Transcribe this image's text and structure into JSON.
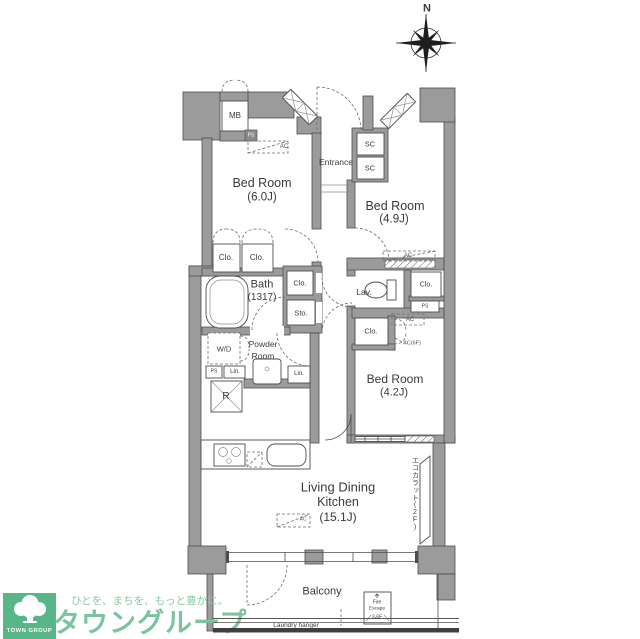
{
  "compass": {
    "north": "N"
  },
  "plan": {
    "rooms": {
      "bedroom1": {
        "name": "Bed Room",
        "size": "(6.0J)"
      },
      "bedroom2": {
        "name": "Bed Room",
        "size": "(4.9J)"
      },
      "bedroom3": {
        "name": "Bed Room",
        "size": "(4.2J)"
      },
      "ldk": {
        "name_line1": "Living Dining",
        "name_line2": "Kitchen",
        "size": "(15.1J)"
      },
      "bath": {
        "name": "Bath",
        "size": "(1317)"
      },
      "powder": {
        "line1": "Powder",
        "line2": "Room"
      },
      "entrance": {
        "name": "Entrance"
      },
      "lavatory": {
        "name": "Lav."
      },
      "balcony": {
        "name": "Balcony"
      }
    },
    "fixtures": {
      "meter_box": "MB",
      "shoe_cabinet_1": "SC",
      "shoe_cabinet_2": "SC",
      "closet_1": "Clo.",
      "closet_2": "Clo.",
      "closet_3": "Clo.",
      "closet_4": "Clo.",
      "closet_5": "Clo.",
      "storage": "Sto.",
      "washer_dryer": "W/D",
      "refrigerator": "R",
      "pipe_space_1": "PS",
      "pipe_space_2": "PS",
      "pipe_space_3": "PS",
      "linen_1": "Lin.",
      "linen_2": "Lin.",
      "ac_1": "AC",
      "ac_2": "AC",
      "ac_3": "AC",
      "ac_ldk": "AC",
      "ac_6f": "AC(6F)",
      "ecocarat": "エコカラット(2F)",
      "laundry_hanger": "Laundry hanger",
      "fire_escape_line1": "Fire",
      "fire_escape_line2": "Escape",
      "fire_escape_line3": "3-6F"
    }
  },
  "logo": {
    "group_en": "TOWN GROUP",
    "tagline": "ひとを、まちを、もっと豊かに。",
    "brand": "タウングループ"
  },
  "colors": {
    "wall": "#9b9b9b",
    "line": "#4a4a4a",
    "logo_green": "#57b788",
    "logo_text_green": "#7cc49f"
  }
}
